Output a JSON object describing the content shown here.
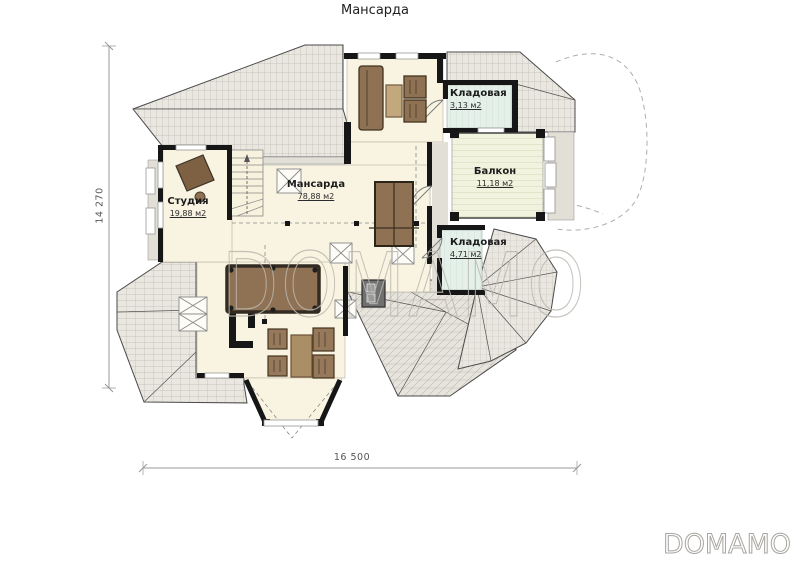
{
  "title": "Мансарда",
  "rooms": {
    "studio": {
      "name": "Студия",
      "area": "19,88 м2"
    },
    "mansarda": {
      "name": "Мансарда",
      "area": "78,88 м2"
    },
    "storage1": {
      "name": "Кладовая",
      "area": "3,13 м2"
    },
    "balcony": {
      "name": "Балкон",
      "area": "11,18 м2"
    },
    "storage2": {
      "name": "Кладовая",
      "area": "4,71 м2"
    }
  },
  "dimensions": {
    "vertical": "14 270",
    "horizontal": "16 500"
  },
  "watermark": "DOMAMO",
  "logo": "DOMAMO",
  "colors": {
    "floor": "#f8f4e1",
    "roof_base": "#eae7e1",
    "roof_line": "#bcb9b1",
    "eave": "#e2dfd7",
    "storage_floor": "#e4f0e9",
    "balcony_floor": "#f2f3de",
    "wall": "#161616",
    "furniture": "#8f7254",
    "dimension": "#999999",
    "watermark_stroke": "#bcb8b0"
  }
}
